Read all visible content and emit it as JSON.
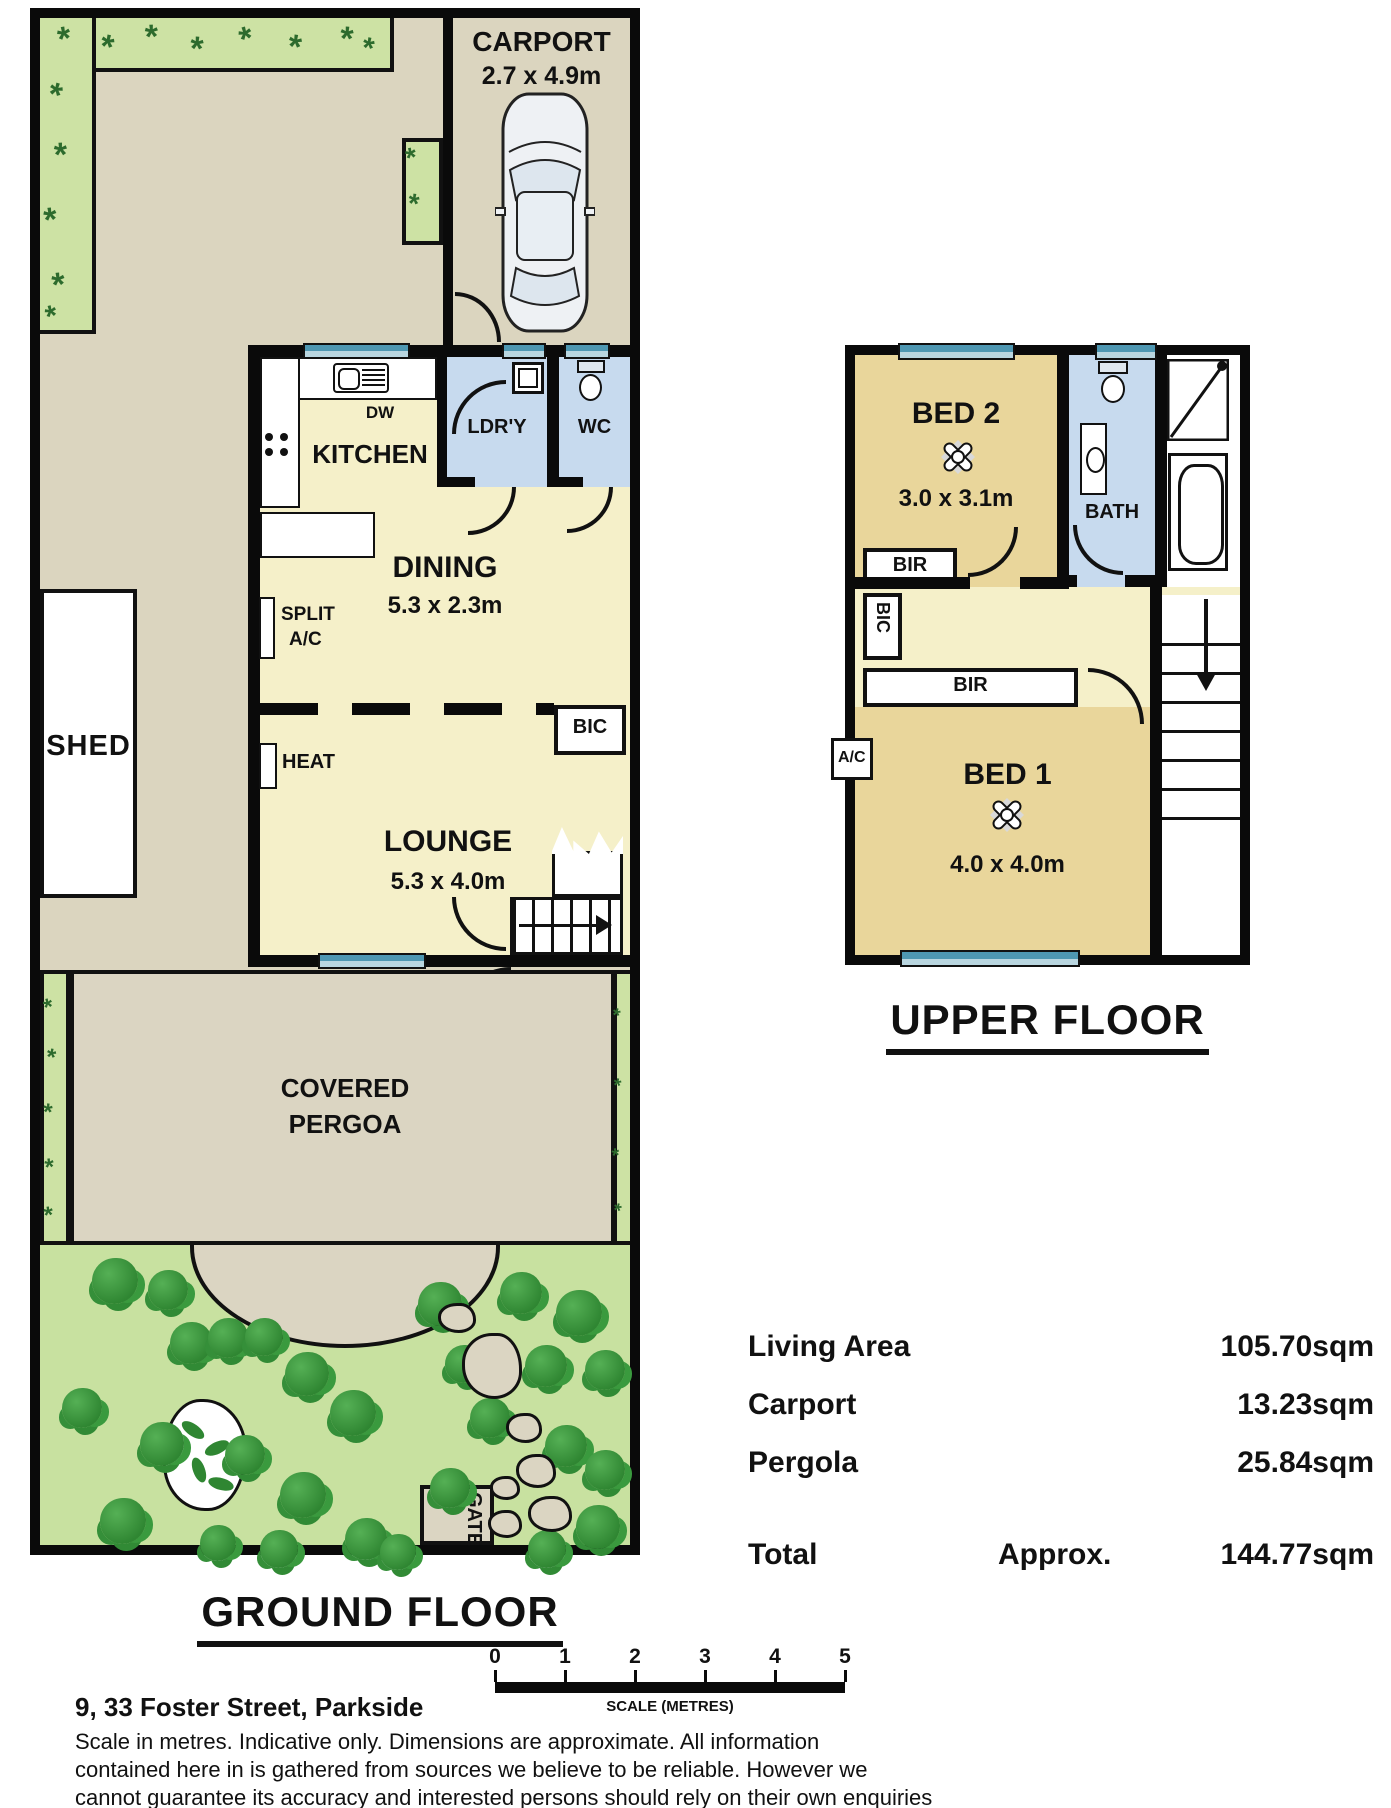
{
  "ground_floor": {
    "title": "GROUND FLOOR",
    "carport": {
      "label": "CARPORT",
      "dims": "2.7 x 4.9m"
    },
    "kitchen": {
      "label": "KITCHEN",
      "dw": "DW"
    },
    "laundry": "LDR'Y",
    "wc": "WC",
    "dining": {
      "label": "DINING",
      "dims": "5.3 x 2.3m"
    },
    "split_ac": {
      "line1": "SPLIT",
      "line2": "A/C"
    },
    "shed": "SHED",
    "heat": "HEAT",
    "bic": "BIC",
    "lounge": {
      "label": "LOUNGE",
      "dims": "5.3 x 4.0m"
    },
    "pergola": {
      "line1": "COVERED",
      "line2": "PERGOA"
    },
    "gate": "GATE"
  },
  "upper_floor": {
    "title": "UPPER FLOOR",
    "bed2": {
      "label": "BED 2",
      "dims": "3.0 x 3.1m"
    },
    "bir_bed2": "BIR",
    "bath": "BATH",
    "bic": "BIC",
    "bir_bed1": "BIR",
    "ac": "A/C",
    "bed1": {
      "label": "BED 1",
      "dims": "4.0 x 4.0m"
    }
  },
  "areas": {
    "rows": [
      {
        "label": "Living Area",
        "value": "105.70sqm"
      },
      {
        "label": "Carport",
        "value": "13.23sqm"
      },
      {
        "label": "Pergola",
        "value": "25.84sqm"
      }
    ],
    "total": {
      "label": "Total",
      "qualifier": "Approx.",
      "value": "144.77sqm"
    }
  },
  "scale_bar": {
    "ticks": [
      "0",
      "1",
      "2",
      "3",
      "4",
      "5"
    ],
    "caption": "SCALE (METRES)"
  },
  "footer": {
    "address": "9, 33 Foster Street, Parkside",
    "disclaimer_lines": [
      "Scale in metres. Indicative only. Dimensions are approximate. All information",
      "contained here in is gathered from sources we believe to be reliable. However we",
      "cannot guarantee its accuracy and interested persons should rely on their own enquiries"
    ]
  },
  "colors": {
    "wall": "#0a0a0a",
    "yard": "#dbd5bf",
    "lawn": "#c8e1a0",
    "bed_green": "#cde2a4",
    "floor_yellow": "#f5f0c9",
    "bedroom_tan": "#e9d69b",
    "wet_blue": "#c7daee",
    "window_teal": "#4e97b2"
  }
}
